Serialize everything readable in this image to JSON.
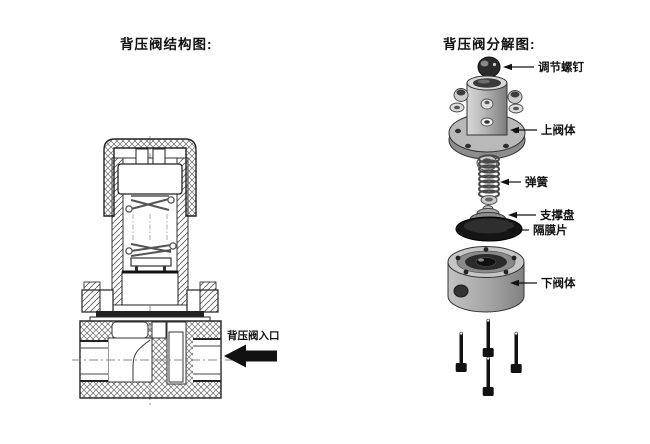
{
  "left_panel": {
    "title": "背压阀结构图:",
    "inlet_label": "背压阀入口"
  },
  "right_panel": {
    "title": "背压阀分解图:",
    "labels": {
      "adjust_screw": "调节螺钉",
      "upper_body": "上阀体",
      "spring": "弹簧",
      "support_plate": "支撑盘",
      "diaphragm": "隔膜片",
      "lower_body": "下阀体"
    }
  },
  "colors": {
    "line": "#1a1a1a",
    "arrow": "#111111",
    "metal_light": "#c8c8c8",
    "metal_mid": "#a0a0a0",
    "metal_dark": "#8a8a8a",
    "diaphragm": "#151515",
    "background": "#ffffff"
  }
}
